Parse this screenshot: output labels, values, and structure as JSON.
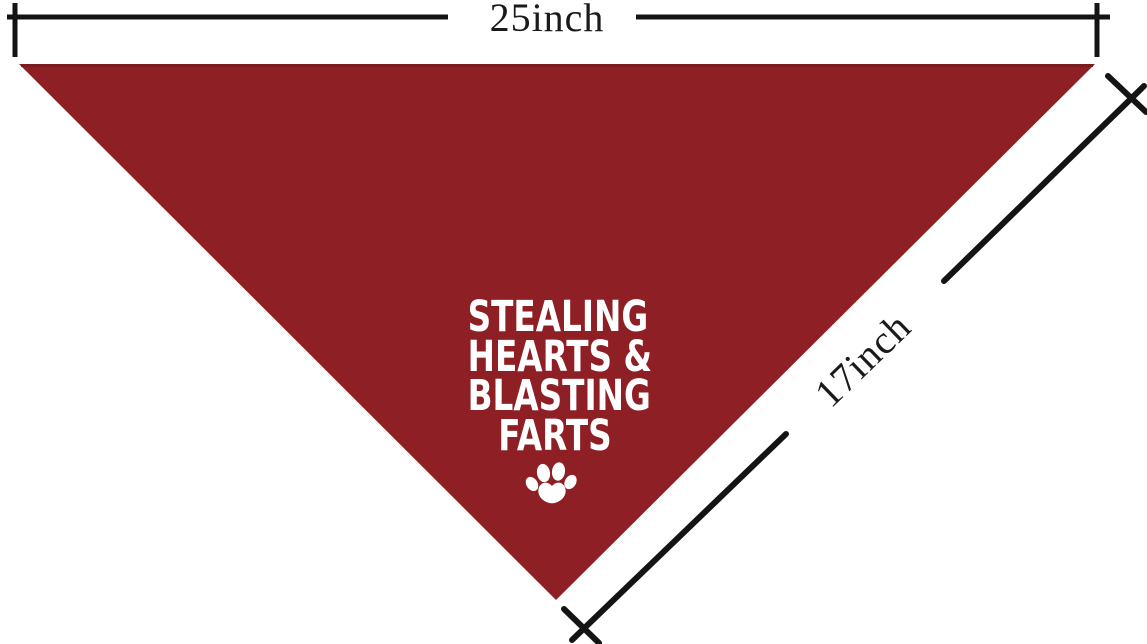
{
  "page": {
    "background_color": "#FFFFFF"
  },
  "bandana": {
    "shape": "triangle",
    "fabric_color": "#8E1F24",
    "top_edge_shade_color": "#7A1B1F",
    "text_color": "#FFFFFF",
    "text_lines": [
      "STEALING",
      "HEARTS &",
      "BLASTING",
      "FARTS"
    ],
    "paw_icon": "paw-print"
  },
  "measurements": {
    "line_color": "#141414",
    "width": {
      "label": "25inch"
    },
    "diagonal": {
      "label": "17inch"
    }
  }
}
